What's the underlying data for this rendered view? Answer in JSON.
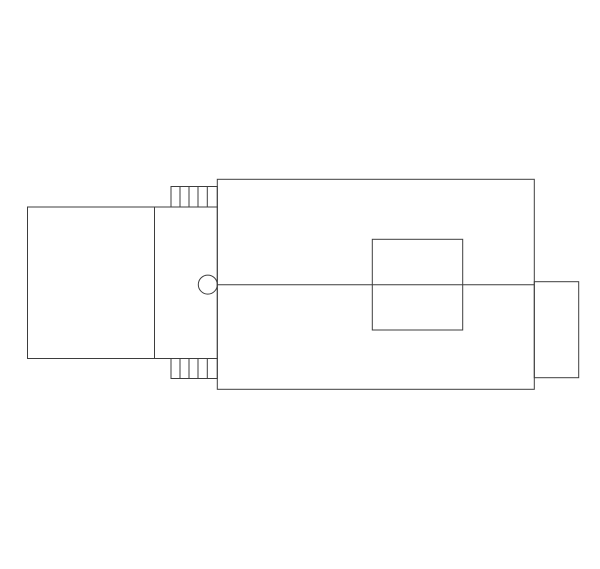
{
  "canvas": {
    "width": 600,
    "height": 569,
    "background_color": "#ffffff",
    "line_color": "#3d3d3d",
    "line_width": 1
  },
  "drawing": {
    "kind": "technical-line-drawing",
    "shapes": [
      {
        "type": "rect",
        "name": "left-body-outline",
        "x": 27.5,
        "y": 207,
        "w": 127,
        "h": 151.5
      },
      {
        "type": "rect",
        "name": "coupler-body-outline",
        "x": 154.5,
        "y": 207,
        "w": 62.8,
        "h": 151.5
      },
      {
        "type": "rect",
        "name": "top-rib-block-outline",
        "x": 171,
        "y": 186.5,
        "w": 46.3,
        "h": 20.5
      },
      {
        "type": "line",
        "name": "top-rib-line",
        "x1": 180,
        "y1": 186.5,
        "x2": 180,
        "y2": 207
      },
      {
        "type": "line",
        "name": "top-rib-line",
        "x1": 189,
        "y1": 186.5,
        "x2": 189,
        "y2": 207
      },
      {
        "type": "line",
        "name": "top-rib-line",
        "x1": 198,
        "y1": 186.5,
        "x2": 198,
        "y2": 207
      },
      {
        "type": "line",
        "name": "top-rib-line",
        "x1": 207.3,
        "y1": 186.5,
        "x2": 207.3,
        "y2": 207
      },
      {
        "type": "rect",
        "name": "bottom-rib-block-outline",
        "x": 171,
        "y": 358.5,
        "w": 46.3,
        "h": 20
      },
      {
        "type": "line",
        "name": "bottom-rib-line",
        "x1": 180,
        "y1": 358.5,
        "x2": 180,
        "y2": 378.5
      },
      {
        "type": "line",
        "name": "bottom-rib-line",
        "x1": 189,
        "y1": 358.5,
        "x2": 189,
        "y2": 378.5
      },
      {
        "type": "line",
        "name": "bottom-rib-line",
        "x1": 198,
        "y1": 358.5,
        "x2": 198,
        "y2": 378.5
      },
      {
        "type": "line",
        "name": "bottom-rib-line",
        "x1": 207.3,
        "y1": 358.5,
        "x2": 207.3,
        "y2": 378.5
      },
      {
        "type": "rect",
        "name": "main-body-outline",
        "x": 217.3,
        "y": 179.3,
        "w": 317,
        "h": 210
      },
      {
        "type": "rect",
        "name": "inner-panel-outline",
        "x": 372.3,
        "y": 239.3,
        "w": 90.4,
        "h": 90.7
      },
      {
        "type": "rect",
        "name": "right-boss-outline",
        "x": 534.3,
        "y": 281.7,
        "w": 44.4,
        "h": 96
      },
      {
        "type": "circle",
        "name": "knob-circle",
        "cx": 207.8,
        "cy": 284.6,
        "r": 9.5
      },
      {
        "type": "line",
        "name": "center-line",
        "x1": 217.3,
        "y1": 284.7,
        "x2": 534.3,
        "y2": 284.7
      }
    ]
  }
}
